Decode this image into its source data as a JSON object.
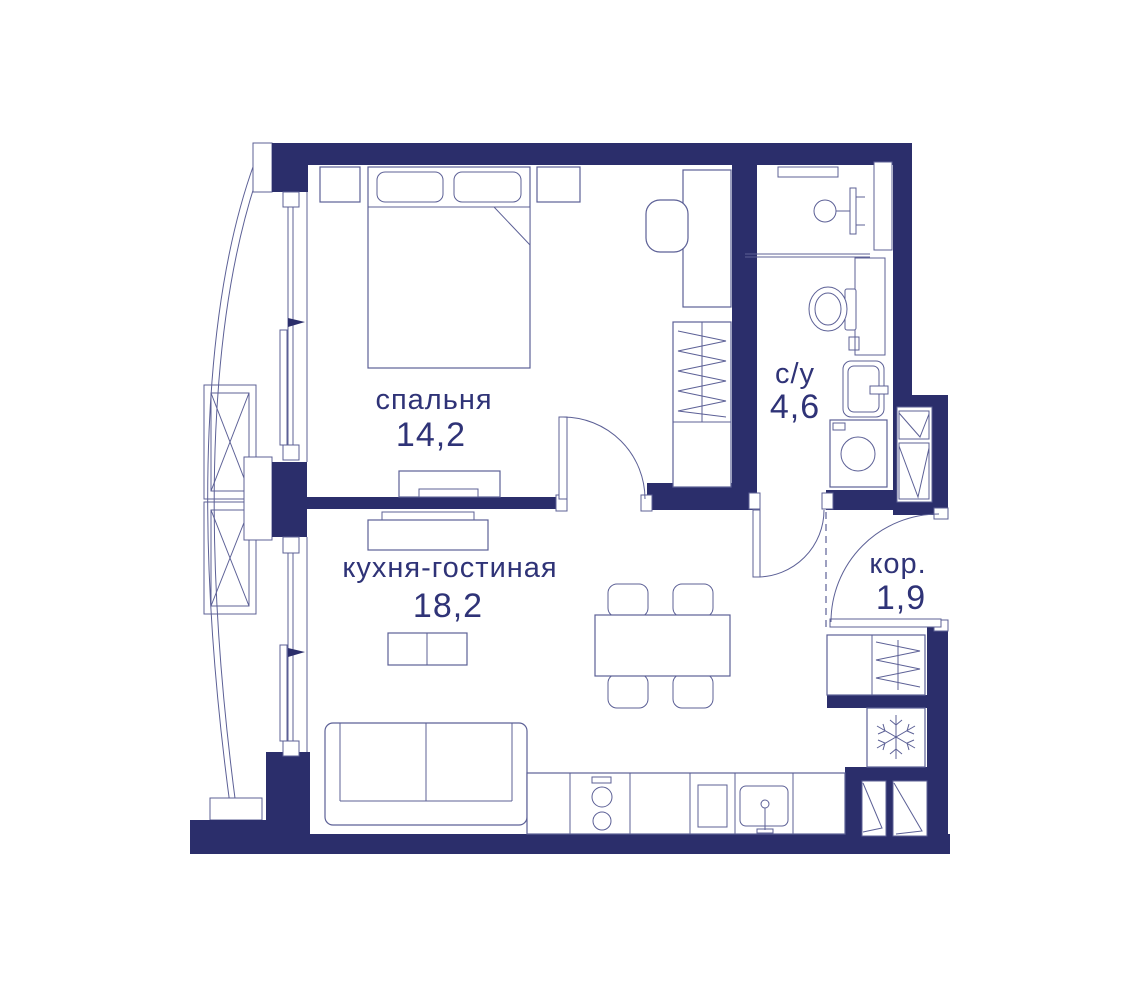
{
  "colors": {
    "wall": "#2b2e6b",
    "line": "#5c6096",
    "linelight": "#8a8db8",
    "text": "#2f3377",
    "bg": "#ffffff"
  },
  "plan": {
    "rooms": [
      {
        "id": "bedroom",
        "name": "спальня",
        "area": "14,2"
      },
      {
        "id": "kitchen-living",
        "name": "кухня-гостиная",
        "area": "18,2"
      },
      {
        "id": "bathroom",
        "name": "с/у",
        "area": "4,6"
      },
      {
        "id": "corridor",
        "name": "кор.",
        "area": "1,9"
      }
    ]
  }
}
